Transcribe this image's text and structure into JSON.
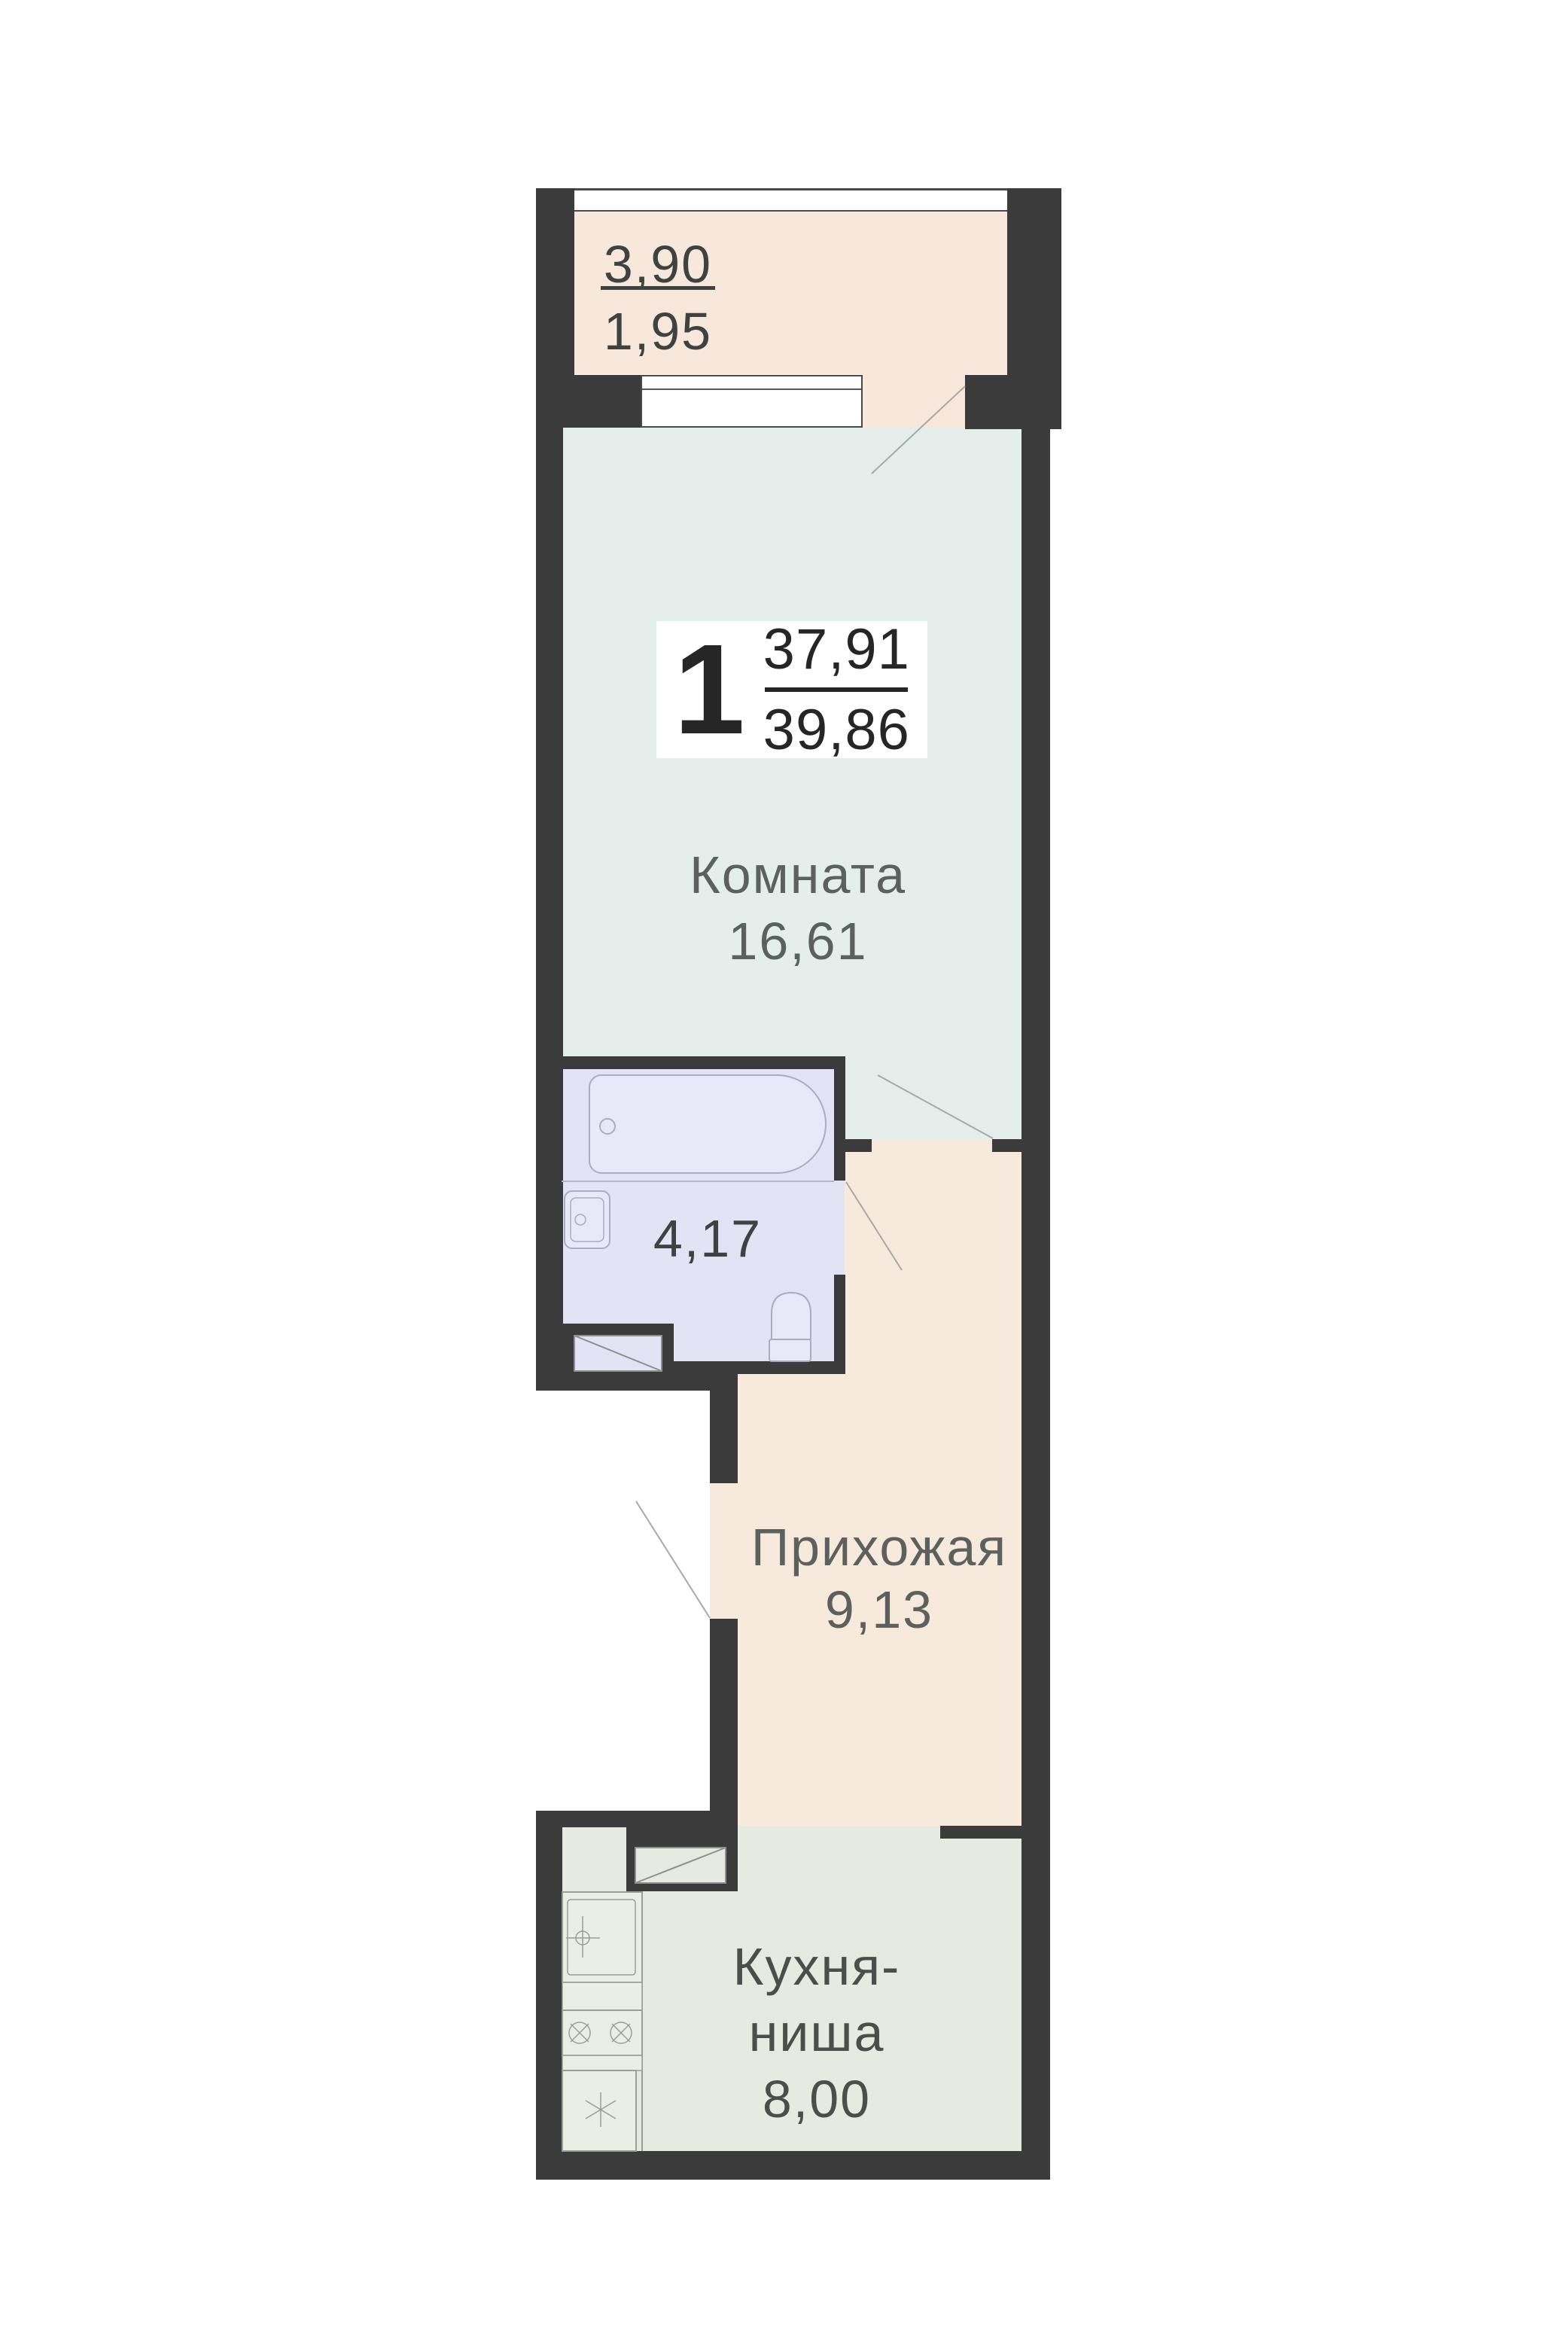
{
  "colors": {
    "wall": "#3b3b3b",
    "balcony-floor": "#f8e8db",
    "hallway-floor": "#f7e9dc",
    "room-floor": "#e4efec",
    "bath-floor": "#e2e4f5",
    "kitchen-floor": "#e5ebe0",
    "window-border": "#4a4a4a",
    "bath-fixture": "#a9adbf",
    "kitchen-fixture": "#97a096",
    "door-line": "#a8a8a8",
    "label-gray": "#5c615e",
    "label-dark": "#3e4240",
    "label-kitchen": "#4a4f4c",
    "number-dark": "#262626"
  },
  "balcony": {
    "length": "3,90",
    "area": "1,95"
  },
  "summary": {
    "room_count": "1",
    "living_area": "37,91",
    "total_area": "39,86"
  },
  "rooms": {
    "living": {
      "name": "Комната",
      "area": "16,61"
    },
    "bathroom": {
      "area": "4,17"
    },
    "hallway": {
      "name": "Прихожая",
      "area": "9,13"
    },
    "kitchen": {
      "line1": "Кухня-",
      "line2": "ниша",
      "area": "8,00"
    }
  }
}
